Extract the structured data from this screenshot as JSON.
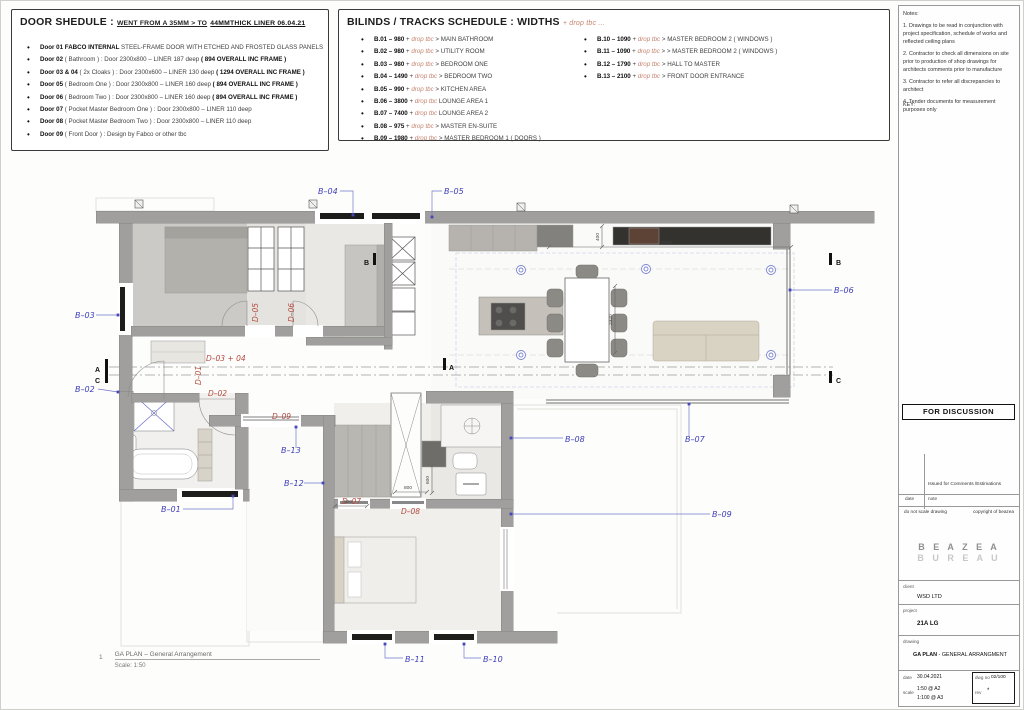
{
  "door_schedule": {
    "title": "DOOR SHEDULE :",
    "subtitle": "WENT FROM A 35MM > TO",
    "subtitle_bold": "44MMTHICK LINER 06.04.21",
    "items": [
      {
        "label": "Door 01  FABCO INTERNAL",
        "text": "STEEL-FRAME DOOR WITH ETCHED AND FROSTED GLASS PANELS",
        "suffix": ""
      },
      {
        "label": "Door 02",
        "text": "( Bathroom ) : Door 2300x800 – LINER 187 deep",
        "suffix": "( 894 OVERALL INC FRAME )"
      },
      {
        "label": "Door 03 & 04",
        "text": "( 2x Cloaks ) : Door 2300x600 – LINER 130 deep",
        "suffix": "( 1294 OVERALL INC FRAME )"
      },
      {
        "label": "Door 05",
        "text": "( Bedroom One ) : Door 2300x800 – LINER 160 deep",
        "suffix": "( 894 OVERALL INC FRAME )"
      },
      {
        "label": "Door 06",
        "text": "( Bedroom Two ) : Door 2300x800 – LINER 160 deep",
        "suffix": "( 894 OVERALL INC FRAME )"
      },
      {
        "label": "Door 07",
        "text": "( Pocket Master Bedroom One ) : Door 2300x800 – LINER 110 deep",
        "suffix": ""
      },
      {
        "label": "Door 08",
        "text": "( Pocket Master Bedroom Two ) : Door 2300x800 – LINER 110 deep",
        "suffix": ""
      },
      {
        "label": "Door 09",
        "text": "( Front Door ) : Design by Fabco or other tbc",
        "suffix": ""
      }
    ]
  },
  "blinds_schedule": {
    "title": "BILINDS / TRACKS SCHEDULE : WIDTHS",
    "title_suffix": "+ drop tbc ...",
    "plus": "+",
    "drop": "drop tbc",
    "left": [
      {
        "code": "B.01 – 980",
        "sep": ">",
        "name": "MAIN BATHROOM"
      },
      {
        "code": "B.02 – 980",
        "sep": ">",
        "name": "UTILITY ROOM"
      },
      {
        "code": "B.03 – 980",
        "sep": ">",
        "name": "BEDROOM ONE"
      },
      {
        "code": "B.04 – 1490",
        "sep": ">",
        "name": "BEDROOM TWO"
      },
      {
        "code": "B.05 – 990",
        "sep": ">",
        "name": "KITCHEN AREA"
      },
      {
        "code": "B.06 – 3800",
        "sep": "",
        "name": "LOUNGE AREA 1"
      },
      {
        "code": "B.07 – 7400",
        "sep": "",
        "name": "LOUNGE AREA 2"
      },
      {
        "code": "B.08 – 975",
        "sep": ">",
        "name": "MASTER EN-SUITE"
      },
      {
        "code": "B.09 – 1980",
        "sep": ">",
        "name": "MASTER BEDROOM 1 ( DOORS )"
      }
    ],
    "right": [
      {
        "code": "B.10 – 1090",
        "sep": ">",
        "name": "MASTER BEDROOM 2 ( WINDOWS )"
      },
      {
        "code": "B.11 – 1090",
        "sep": "> >",
        "name": "MASTER BEDROOM 2 ( WINDOWS )"
      },
      {
        "code": "B.12 – 1790",
        "sep": ">",
        "name": "HALL TO MASTER"
      },
      {
        "code": "B.13 – 2100",
        "sep": ">",
        "name": "FRONT DOOR ENTRANCE"
      }
    ]
  },
  "notes_panel": {
    "heading": "Notes:",
    "notes": [
      "1. Drawings to be read in conjunction with project specification, schedule of works and reflected ceiling plans",
      "2. Contractor to check all dimensions on site prior to production of shop drawings for architects comments prior to manufacture",
      "3. Contractor to refer all discrepancies to architect",
      "4. Tender documents for measurement purposes only"
    ],
    "key_label": "KEY:"
  },
  "status_box": {
    "label": "FOR DISCUSSION"
  },
  "revision": {
    "note": "Issued for Comments /Estimations",
    "col_date": "date",
    "col_note": "note",
    "disclaimer_left": "do not scale drawing",
    "disclaimer_right": "copyright of beazea"
  },
  "logo": {
    "line1": "B E A Z E A",
    "line2": "B U R E A U"
  },
  "title_block": {
    "client_label": "client",
    "client": "WSD LTD",
    "project_label": "project",
    "project": "21A LG",
    "drawing_label": "drawing",
    "drawing_bold": "GA PLAN",
    "drawing_rest": " - GENERAL ARRANGMENT",
    "date_label": "date",
    "date": "30.04.2021",
    "scale_label": "scale",
    "scale1": "1:50 @ A2",
    "scale2": "1:100 @ A3",
    "dwgno_label": "dwg no",
    "dwgno": "02/100",
    "rev_label": "rev",
    "rev": "*"
  },
  "plan": {
    "caption_no": "1",
    "caption_title": "GA PLAN – General Arrangement",
    "caption_scale": "Scale: 1:50",
    "colors": {
      "accent_blue": "#3d3dbb",
      "accent_red": "#b34a3e",
      "drop_tbc": "#c4826e",
      "wall_gray": "#a09f9d"
    },
    "blind_labels": [
      {
        "id": "B–01",
        "x": 160,
        "y": 511,
        "pts": "182,508 232,508 232,495"
      },
      {
        "id": "B–02",
        "x": 74,
        "y": 391,
        "pts": "97,388 117,391"
      },
      {
        "id": "B–03",
        "x": 74,
        "y": 317,
        "pts": "95,314 117,314"
      },
      {
        "id": "B–04",
        "x": 317,
        "y": 193,
        "pts": "339,190 352,190 352,214"
      },
      {
        "id": "B–05",
        "x": 443,
        "y": 193,
        "pts": "441,190 431,190 431,216"
      },
      {
        "id": "B–06",
        "x": 833,
        "y": 292,
        "pts": "831,289 789,289"
      },
      {
        "id": "B–07",
        "x": 684,
        "y": 441,
        "pts": "688,435 688,403"
      },
      {
        "id": "B–08",
        "x": 564,
        "y": 441,
        "pts": "562,437 510,437"
      },
      {
        "id": "B–09",
        "x": 711,
        "y": 516,
        "pts": "709,513 510,513"
      },
      {
        "id": "B–10",
        "x": 482,
        "y": 661,
        "pts": "480,657 463,657 463,643"
      },
      {
        "id": "B–11",
        "x": 404,
        "y": 661,
        "pts": "402,657 384,657 384,643"
      },
      {
        "id": "B–12",
        "x": 283,
        "y": 485,
        "pts": "303,482 322,482"
      },
      {
        "id": "B–13",
        "x": 280,
        "y": 452,
        "pts": "295,447 295,426"
      }
    ],
    "door_labels": [
      {
        "id": "D–01",
        "x": 200,
        "y": 384,
        "rot": true
      },
      {
        "id": "D–02",
        "x": 207,
        "y": 395
      },
      {
        "id": "D–03 + 04",
        "x": 205,
        "y": 360
      },
      {
        "id": "D–05",
        "x": 257,
        "y": 321,
        "rot": true
      },
      {
        "id": "D–06",
        "x": 293,
        "y": 321,
        "rot": true
      },
      {
        "id": "D–07",
        "x": 341,
        "y": 503
      },
      {
        "id": "D–08",
        "x": 400,
        "y": 513
      },
      {
        "id": "D–09",
        "x": 271,
        "y": 418
      }
    ],
    "section_markers": [
      {
        "t": "A",
        "x": 94,
        "y": 371,
        "bx": 104,
        "by": 358
      },
      {
        "t": "C",
        "x": 94,
        "y": 382,
        "bx": 104,
        "by": 370
      },
      {
        "t": "B",
        "x": 363,
        "y": 264,
        "bx": 372,
        "by": 252
      },
      {
        "t": "A",
        "x": 448,
        "y": 369,
        "bx": 442,
        "by": 357
      },
      {
        "t": "B",
        "x": 835,
        "y": 264,
        "bx": 828,
        "by": 252
      },
      {
        "t": "C",
        "x": 835,
        "y": 382,
        "bx": 828,
        "by": 370
      }
    ],
    "dimensions": [
      {
        "t": "4413",
        "x1": 548,
        "y1": 246,
        "x2": 790,
        "y2": 246,
        "tx": 660,
        "ty": 243
      },
      {
        "t": "400",
        "x1": 601,
        "y1": 225,
        "x2": 601,
        "y2": 246,
        "tx": 598,
        "ty": 240,
        "rot": true
      },
      {
        "t": "2320",
        "x1": 614,
        "y1": 285,
        "x2": 614,
        "y2": 352,
        "tx": 611,
        "ty": 324,
        "rot": true
      },
      {
        "t": "800",
        "x1": 334,
        "y1": 505,
        "x2": 366,
        "y2": 505,
        "tx": 343,
        "ty": 502
      },
      {
        "t": "800",
        "x1": 394,
        "y1": 491,
        "x2": 426,
        "y2": 491,
        "tx": 403,
        "ty": 488
      },
      {
        "t": "600",
        "x1": 431,
        "y1": 464,
        "x2": 431,
        "y2": 492,
        "tx": 428,
        "ty": 483,
        "rot": true
      }
    ]
  }
}
